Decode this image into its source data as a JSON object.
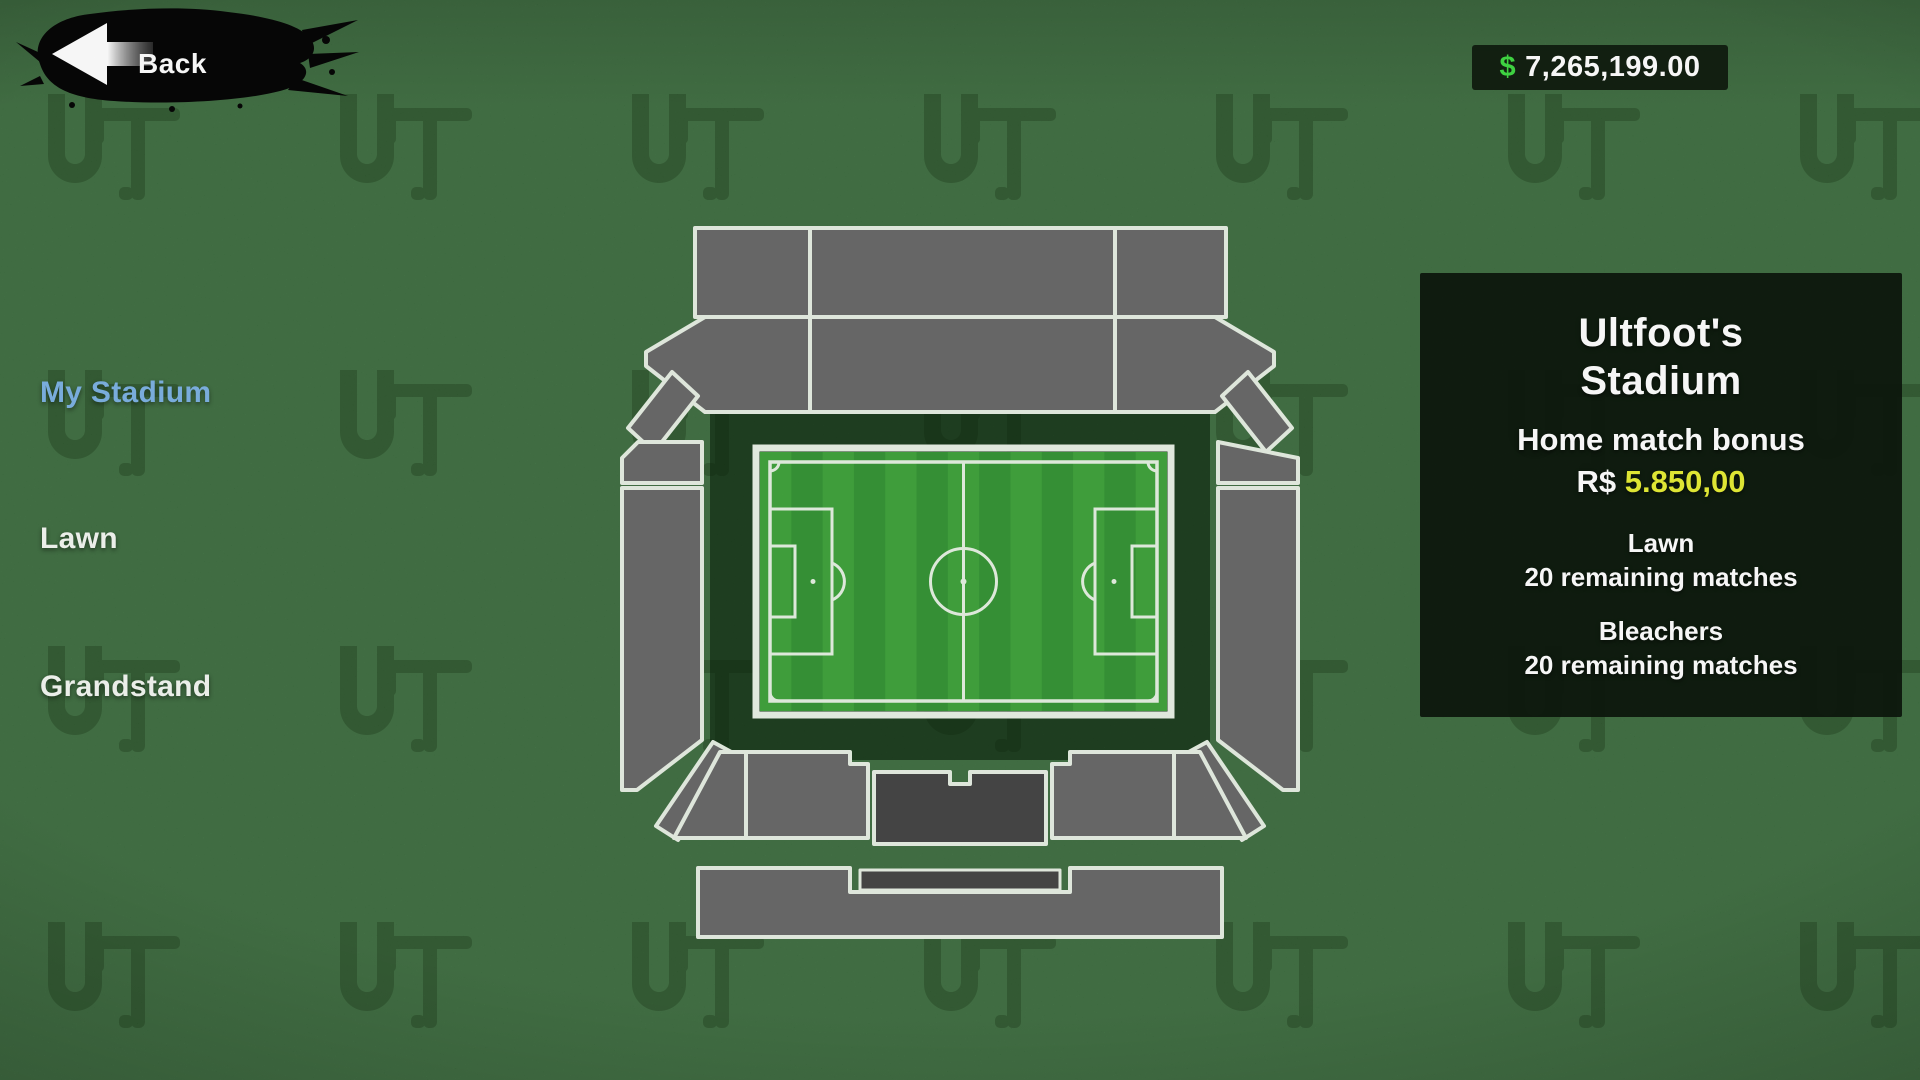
{
  "header": {
    "back_label": "Back",
    "balance": {
      "currency": "$",
      "amount": "7,265,199.00"
    }
  },
  "sidebar": {
    "items": [
      {
        "id": "my-stadium",
        "label": "My Stadium",
        "active": true
      },
      {
        "id": "lawn",
        "label": "Lawn",
        "active": false
      },
      {
        "id": "grandstand",
        "label": "Grandstand",
        "active": false
      }
    ]
  },
  "stadium_panel": {
    "title_line1": "Ultfoot's",
    "title_line2": "Stadium",
    "bonus_label": "Home match bonus",
    "bonus_currency": "R$",
    "bonus_amount": "5.850,00",
    "sections": [
      {
        "name": "Lawn",
        "remaining": "20 remaining matches"
      },
      {
        "name": "Bleachers",
        "remaining": "20 remaining matches"
      }
    ]
  },
  "watermark_text": "UFT",
  "colors": {
    "money_green": "#41d944",
    "bonus_yellow": "#e7ee36",
    "active_item_blue": "#7eb3e4",
    "stand_gray": "#6a6a6a",
    "stand_dark": "#474747",
    "stand_border": "#e7efe3",
    "pitch_stripe_light": "#42a33e",
    "pitch_stripe_dark": "#379537",
    "pitch_line": "#e6f1e2",
    "grass_base": "#37743a",
    "apron_dark": "#28552a"
  }
}
